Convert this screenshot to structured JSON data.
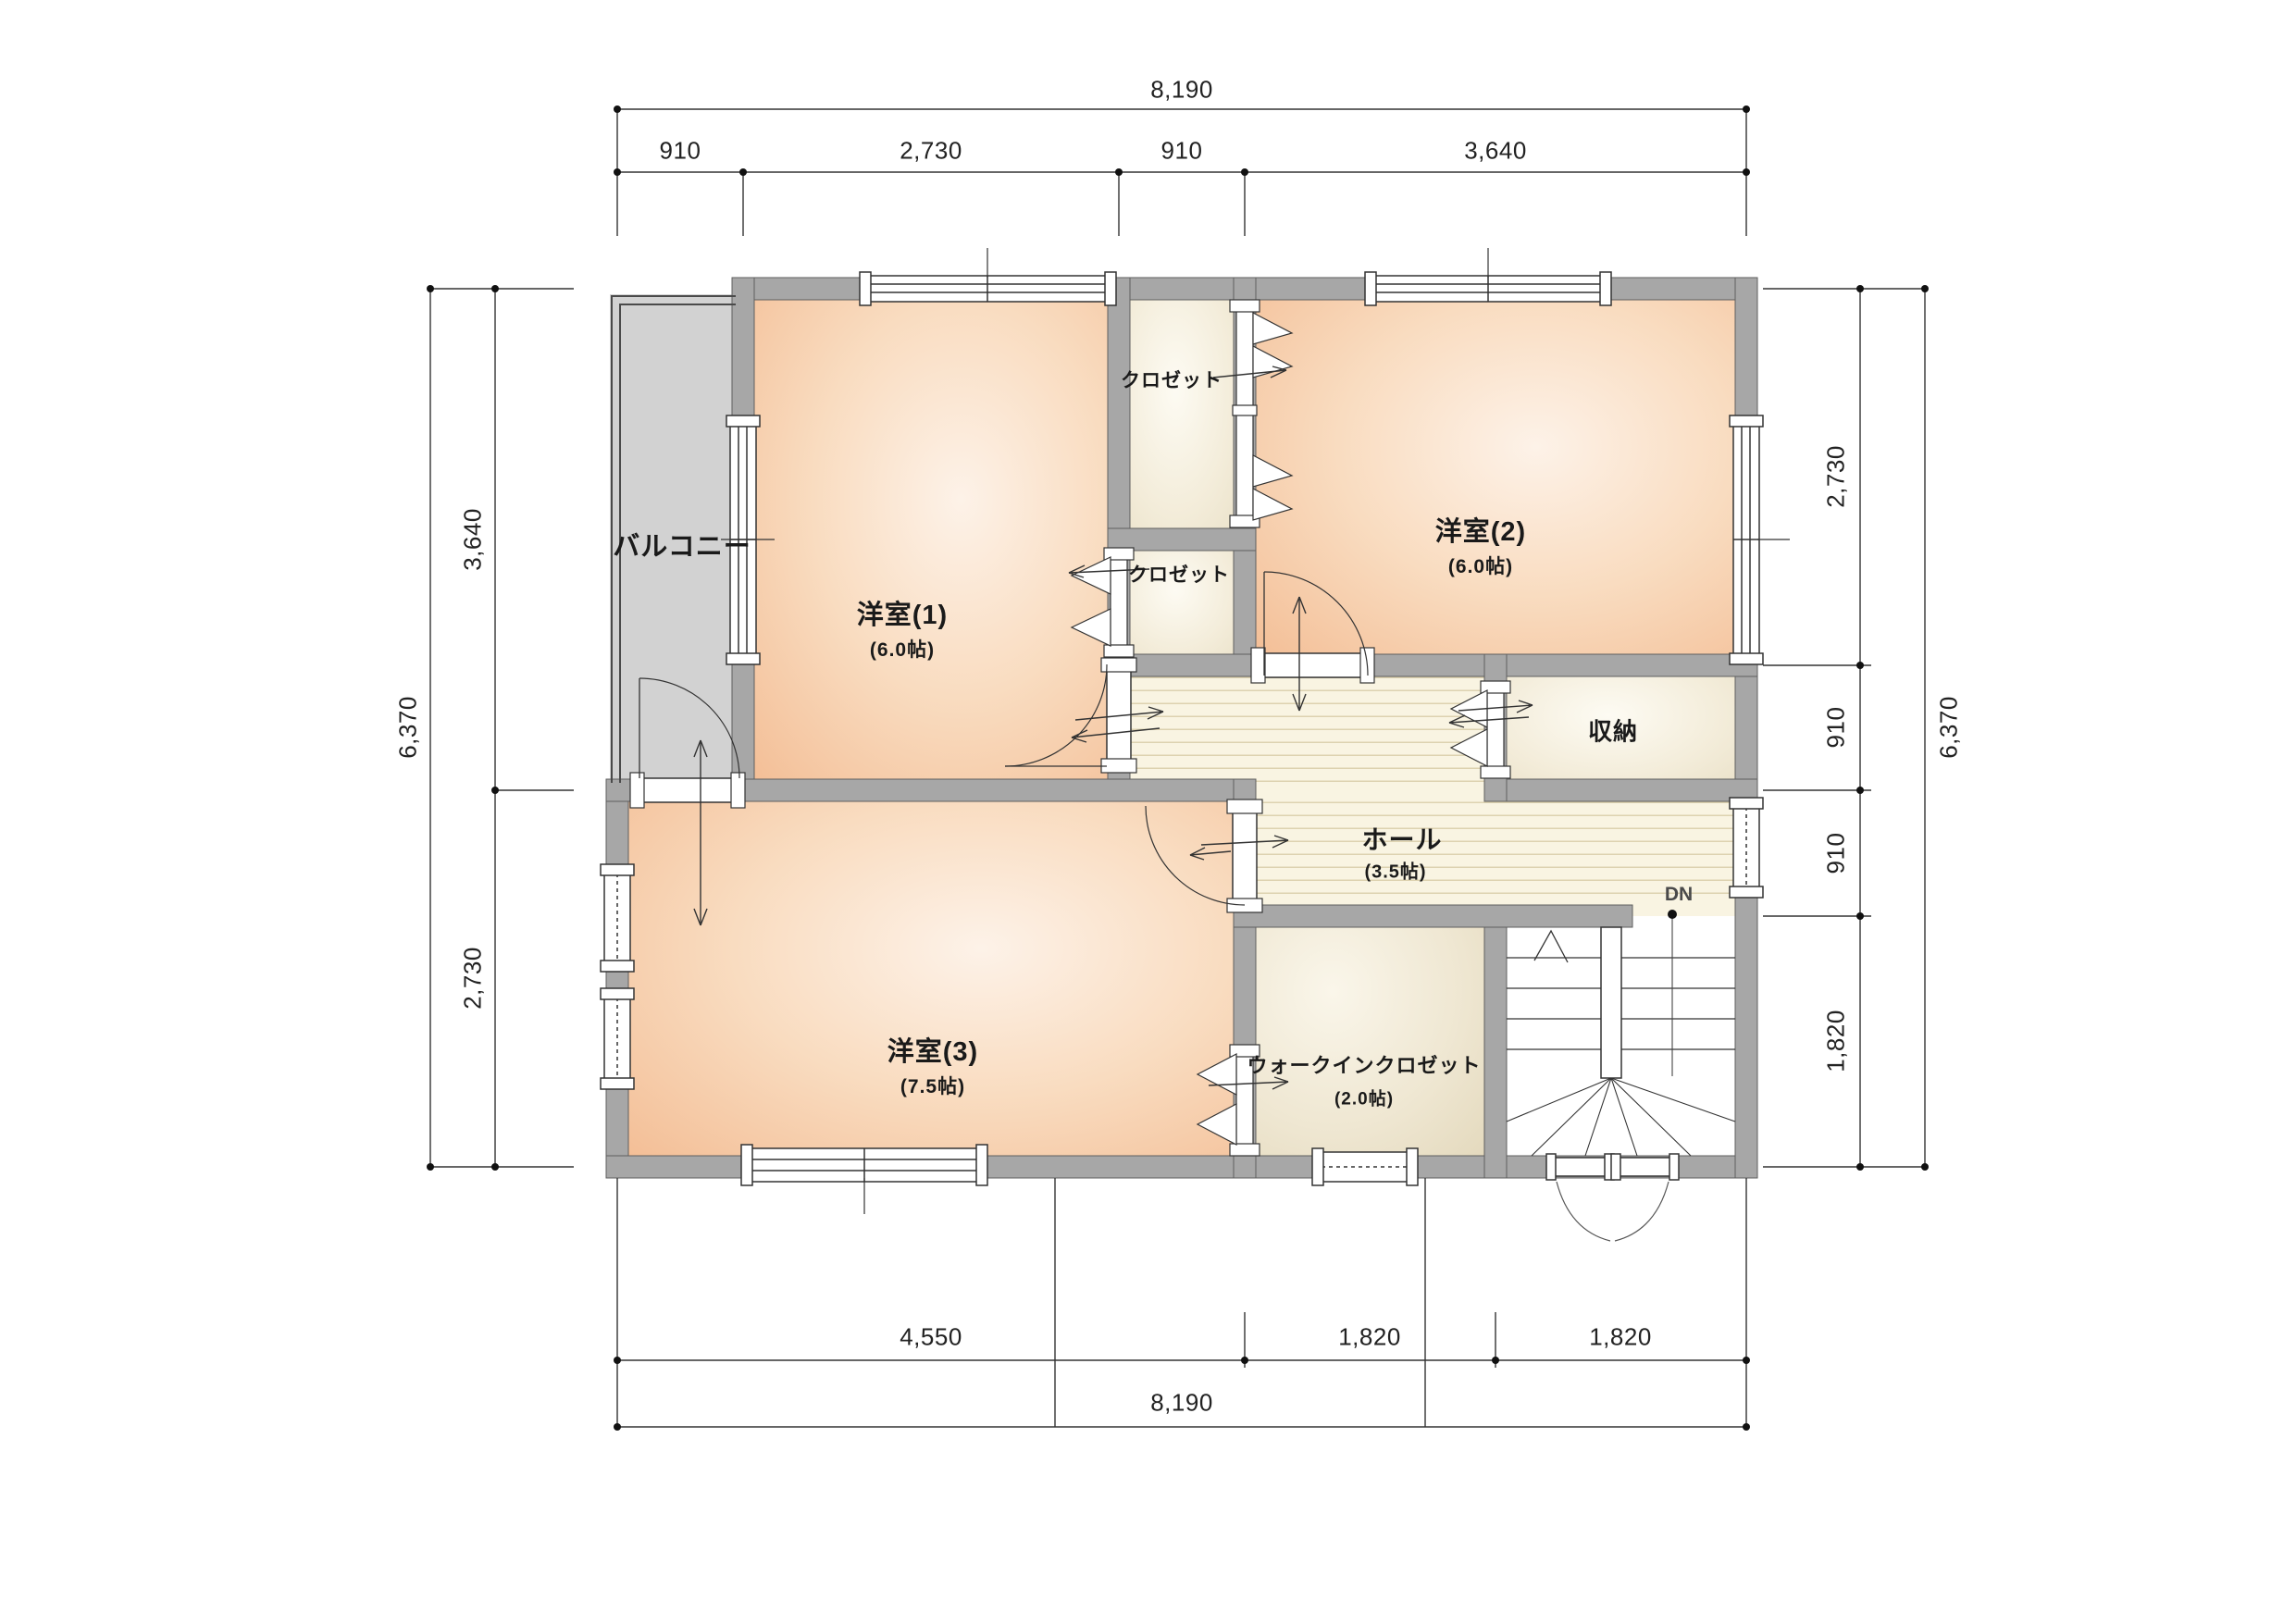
{
  "plan": {
    "title": "2F floor plan",
    "rooms": {
      "balcony": {
        "name": "バルコニー"
      },
      "room1": {
        "name": "洋室(1)",
        "size": "(6.0帖)"
      },
      "room2": {
        "name": "洋室(2)",
        "size": "(6.0帖)"
      },
      "room3": {
        "name": "洋室(3)",
        "size": "(7.5帖)"
      },
      "closet_upper": {
        "name": "クロゼット"
      },
      "closet_lower": {
        "name": "クロゼット"
      },
      "storage": {
        "name": "収納"
      },
      "hall": {
        "name": "ホール",
        "size": "(3.5帖)"
      },
      "wic": {
        "name": "ウォークインクロゼット",
        "size": "(2.0帖)"
      },
      "stairs": {
        "down_label": "DN"
      }
    },
    "dimensions": {
      "top": {
        "total": "8,190",
        "segments": [
          "910",
          "2,730",
          "910",
          "3,640"
        ]
      },
      "bottom": {
        "total": "8,190",
        "segments": [
          "4,550",
          "1,820",
          "1,820"
        ]
      },
      "left": {
        "total": "6,370",
        "segments": [
          "3,640",
          "2,730"
        ]
      },
      "right": {
        "total": "6,370",
        "segments": [
          "2,730",
          "910",
          "910",
          "1,820"
        ]
      }
    },
    "colors": {
      "wall": "#a7a7a7",
      "room_peach": "#f6c8a2",
      "floor_cream": "#f3ecd9",
      "hall_plank": "#f9f4e2",
      "balcony_grey": "#d2d2d2",
      "line": "#333333"
    }
  }
}
